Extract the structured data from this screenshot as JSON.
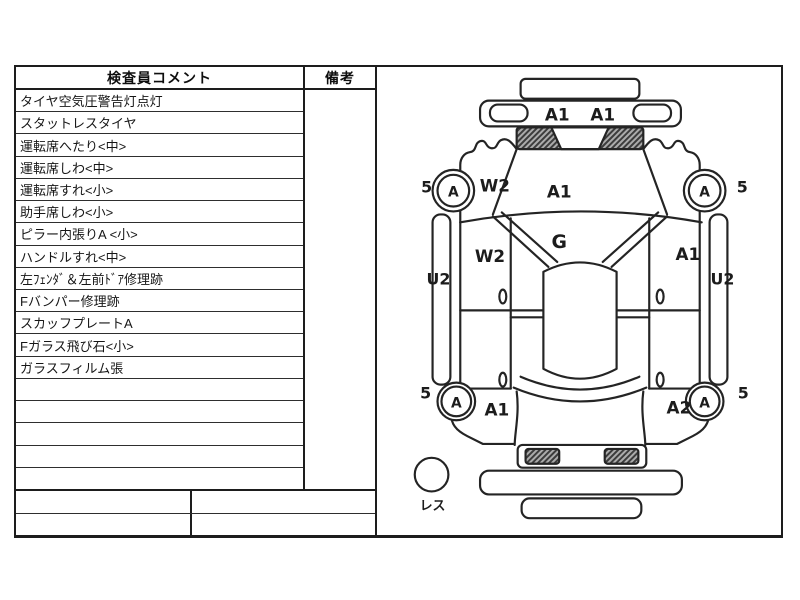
{
  "table": {
    "header": {
      "comments": "検査員コメント",
      "remarks": "備考"
    },
    "rows": [
      "タイヤ空気圧警告灯点灯",
      "スタットレスタイヤ",
      "運転席へたり<中>",
      "運転席しわ<中>",
      "運転席すれ<小>",
      "助手席しわ<小>",
      "ピラー内張りA <小>",
      "ハンドルすれ<中>",
      "左ﾌｪﾝﾀﾞ＆左前ﾄﾞｱ修理跡",
      "Fバンパー修理跡",
      "スカッフプレートA",
      "Fガラス飛び石<小>",
      "ガラスフィルム張",
      "",
      "",
      "",
      "",
      ""
    ]
  },
  "diagram": {
    "front_bumper_mark_left": "A1",
    "front_bumper_mark_right": "A1",
    "hood_mark": "A1",
    "windshield_mark": "G",
    "left_front_fender_mark": "W2",
    "left_front_door_mark": "W2",
    "right_front_door_mark": "A1",
    "left_sill_mark": "U2",
    "right_sill_mark": "U2",
    "left_rear_quarter_mark": "A1",
    "right_rear_quarter_mark": "A2",
    "left_front_wheel_mark": "A",
    "left_front_wheel_size": "5",
    "right_front_wheel_mark": "A",
    "right_front_wheel_size": "5",
    "left_rear_wheel_mark": "A",
    "left_rear_wheel_size": "5",
    "right_rear_wheel_mark": "A",
    "right_rear_wheel_size": "5",
    "spare_tire_label": "レス"
  }
}
